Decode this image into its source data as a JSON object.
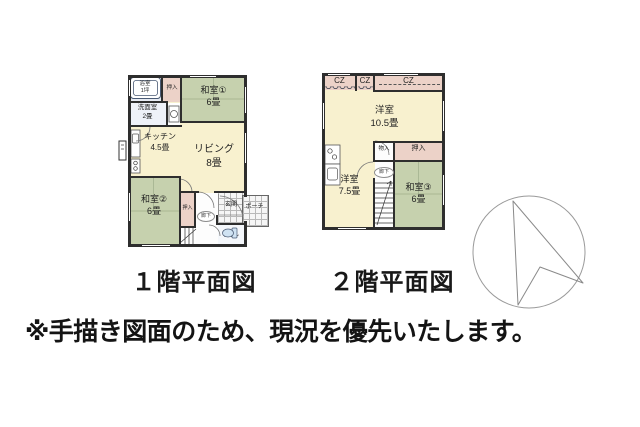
{
  "colors": {
    "wall": "#2e2e2e",
    "cream": "#f8f1cf",
    "green": "#c6d1ae",
    "pink": "#ecd2c8",
    "bathblue": "#e7ebf3",
    "washwhite": "#eef1f8",
    "hallwhite": "#fdfdfd",
    "toiletblue": "#cfe2f2",
    "fixture": "#4a5a74",
    "tileline": "#b9b9b9"
  },
  "icons": {
    "compass": "north-arrow-in-circle"
  },
  "floor1": {
    "caption": "１階平面図",
    "rooms": {
      "bath": {
        "label": "浴室",
        "size": "1坪"
      },
      "closet_top": {
        "label": "押入"
      },
      "washitsu1": {
        "label": "和室①",
        "size": "6畳"
      },
      "washroom": {
        "label": "洗面室",
        "size": "2畳"
      },
      "kitchen": {
        "label": "キッチン",
        "size": "4.5畳"
      },
      "living": {
        "label": "リビング",
        "size": "8畳"
      },
      "washitsu2": {
        "label": "和室②",
        "size": "6畳"
      },
      "closet_hall": {
        "label": "押入"
      },
      "hallway": {
        "label": "廊下"
      },
      "entrance": {
        "label": "玄関"
      },
      "porch": {
        "label": "ポーチ"
      },
      "toilet": {
        "label": "トイレ"
      }
    }
  },
  "floor2": {
    "caption": "２階平面図",
    "rooms": {
      "cz1": {
        "label": "CZ"
      },
      "cz2": {
        "label": "CZ"
      },
      "cz3": {
        "label": "CZ"
      },
      "western_105": {
        "label": "洋室",
        "size": "10.5畳"
      },
      "storage": {
        "label": "物入"
      },
      "closet": {
        "label": "押入"
      },
      "western_75": {
        "label": "洋室",
        "size": "7.5畳"
      },
      "washitsu3": {
        "label": "和室③",
        "size": "6畳"
      },
      "hallway": {
        "label": "廊下"
      }
    }
  },
  "note": "※手描き図面のため、現況を優先いたします。"
}
